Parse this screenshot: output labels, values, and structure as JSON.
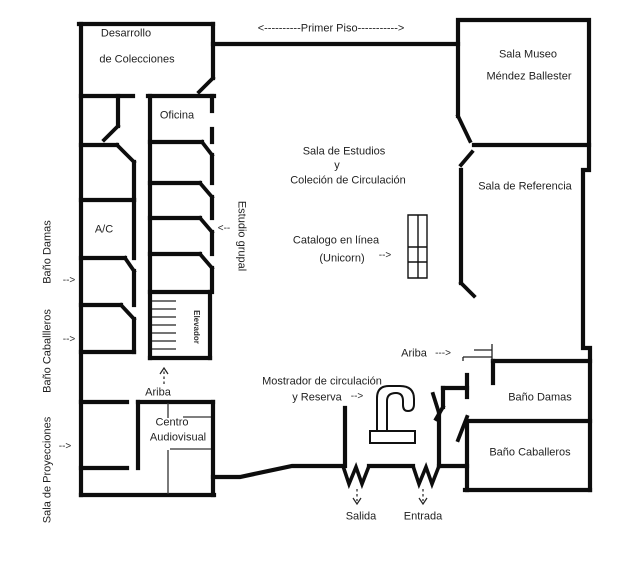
{
  "colors": {
    "wall": "#0d0d0d",
    "text": "#1f1f1f",
    "background": "#ffffff"
  },
  "corridor": {
    "primer_piso": "<----------Primer Piso----------->"
  },
  "rooms": {
    "desarrollo": {
      "line1": "Desarrollo",
      "line2": "de Colecciones"
    },
    "sala_museo": {
      "line1": "Sala Museo",
      "line2": "Méndez Ballester"
    },
    "oficina": "Oficina",
    "sala_estudios": {
      "line1": "Sala de Estudios",
      "line2": "y",
      "line3": "Coleción de Circulación"
    },
    "sala_referencia": "Sala de Referencia",
    "ac": "A/C",
    "estudio_grupal": "Estudio grupal",
    "elevador": "Elevador",
    "centro_audiovisual": {
      "line1": "Centro",
      "line2": "Audiovisual"
    },
    "bano_damas": "Baño Damas",
    "bano_caballeros": "Baño Caballeros"
  },
  "side_labels": {
    "bano_damas": "Baño Damas",
    "bano_caballeros": "Baño Caballleros",
    "sala_proyecciones": "Sala de Proyecciones"
  },
  "annotations": {
    "catalogo": {
      "line1": "Catalogo en línea",
      "line2": "(Unicorn)"
    },
    "mostrador": {
      "line1": "Mostrador de circulación",
      "line2": "y Reserva"
    },
    "ariba_elevator": "Ariba",
    "ariba_stairs": "Ariba",
    "salida": "Salida",
    "entrada": "Entrada"
  },
  "arrows": {
    "right": "-->",
    "left": "<--",
    "long_right": "--->"
  }
}
